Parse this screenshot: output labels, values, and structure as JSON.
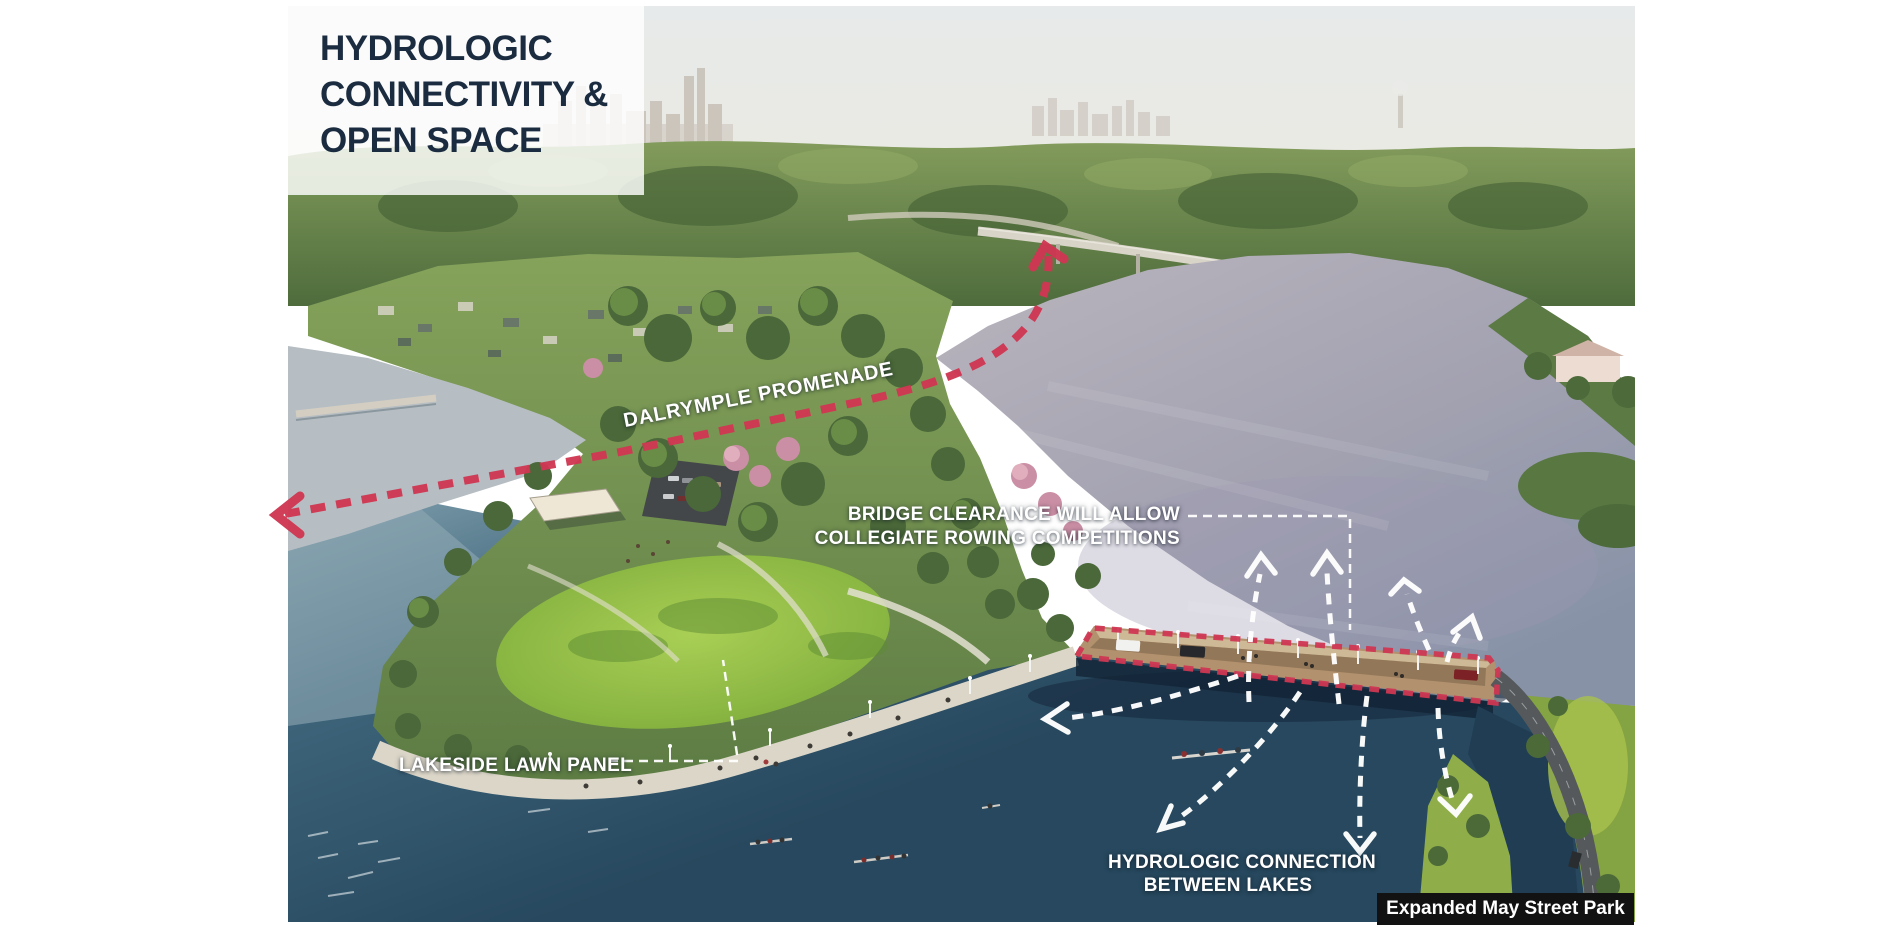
{
  "title_card": {
    "line1": "HYDROLOGIC",
    "line2": "CONNECTIVITY &",
    "line3": "OPEN SPACE"
  },
  "annotations": {
    "promenade_label": "DALRYMPLE PROMENADE",
    "bridge_clearance_line1": "BRIDGE CLEARANCE WILL ALLOW",
    "bridge_clearance_line2": "COLLEGIATE ROWING COMPETITIONS",
    "lakeside_label": "LAKESIDE LAWN PANEL",
    "hydrologic_line1": "HYDROLOGIC CONNECTION",
    "hydrologic_line2": "BETWEEN LAKES",
    "caption": "Expanded May Street Park"
  },
  "colors": {
    "accent_red": "#cf3752",
    "title_navy": "#1b2c40",
    "annotation_white": "#ffffff",
    "caption_bg": "#121212"
  }
}
